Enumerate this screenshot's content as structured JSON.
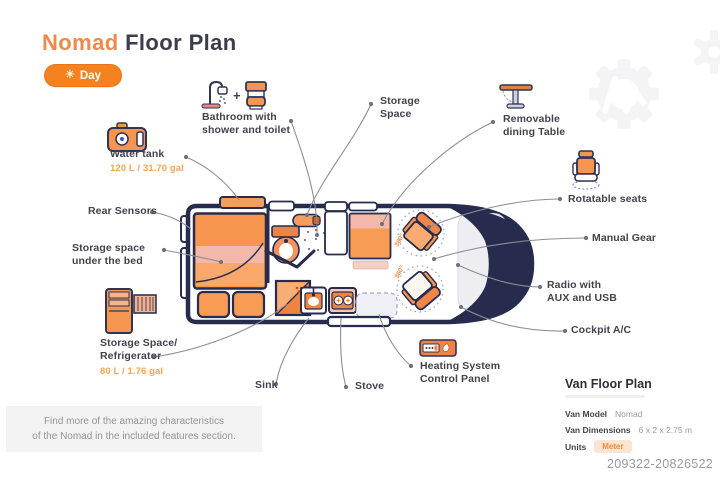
{
  "header": {
    "title_accent": "Nomad",
    "title_rest": "Floor Plan",
    "mode_button_label": "Day",
    "sun_icon": "☀"
  },
  "colors": {
    "accent_orange": "#ef8a4b",
    "fill_orange": "#f79b55",
    "deep_orange": "#ef8343",
    "navy_outline": "#272b4d",
    "leader_gray": "#8e8e96",
    "dotted_circle": "#9a9fd0",
    "badge_bg": "#fbe4d2",
    "footer_bg": "#f3f3f4"
  },
  "callouts": {
    "bathroom": {
      "label": "Bathroom with shower and toilet",
      "plus": "+"
    },
    "storage_space": {
      "label": "Storage Space"
    },
    "removable_table": {
      "label": "Removable dining Table"
    },
    "water_tank": {
      "label": "Water tank",
      "capacity": "120 L / 31.70 gal"
    },
    "rotatable_seats": {
      "label": "Rotatable seats"
    },
    "rear_sensors": {
      "label": "Rear Sensors"
    },
    "manual_gear": {
      "label": "Manual Gear"
    },
    "storage_under_bed": {
      "label": "Storage space under the bed"
    },
    "radio": {
      "label": "Radio with AUX and USB"
    },
    "storage_fridge": {
      "label": "Storage Space/ Refrigerator",
      "capacity": "80 L / 1.76 gal"
    },
    "cockpit_ac": {
      "label": "Cockpit A/C"
    },
    "sink": {
      "label": "Sink"
    },
    "stove": {
      "label": "Stove"
    },
    "heating": {
      "label": "Heating System Control Panel"
    }
  },
  "floorplan": {
    "rotation_labels": [
      "360°",
      "360°"
    ]
  },
  "info_panel": {
    "title": "Van Floor Plan",
    "rows": [
      {
        "key": "Van Model",
        "value": "Nomad"
      },
      {
        "key": "Van Dimensions",
        "value": "6 x 2 x 2.75 m"
      },
      {
        "key": "Units",
        "value": "Meter"
      }
    ]
  },
  "footer": {
    "note_line1": "Find more of the amazing characteristics",
    "note_line2": "of the Nomad in the included features section.",
    "document_id": "209322-20826522"
  }
}
